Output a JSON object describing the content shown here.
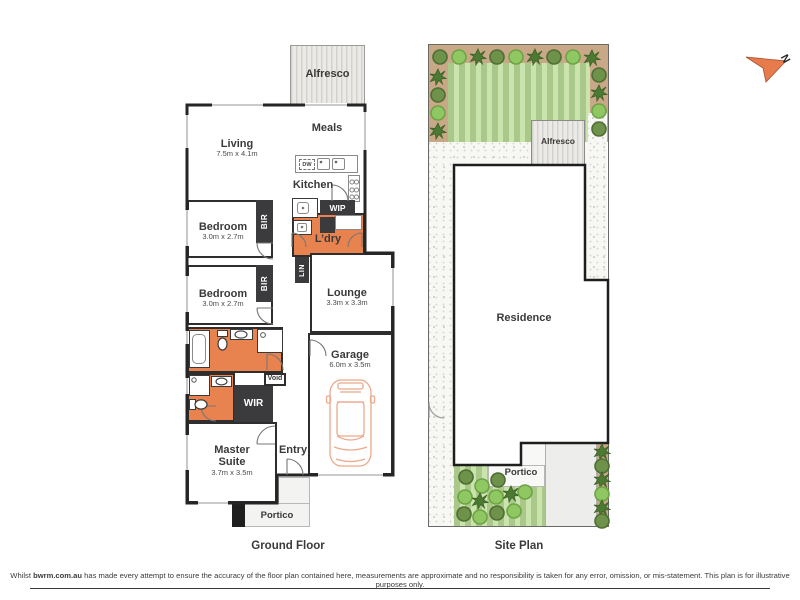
{
  "page": {
    "floor_plan_title": "Ground Floor",
    "site_plan_title": "Site Plan",
    "compass_letter": "N"
  },
  "rooms": {
    "alfresco": "Alfresco",
    "meals": "Meals",
    "living": {
      "name": "Living",
      "dims": "7.5m x 4.1m"
    },
    "kitchen": "Kitchen",
    "dw": "DW",
    "wip": "WIP",
    "ldry": "L’dry",
    "lin": "LIN",
    "bir": "BIR",
    "bedroom": {
      "name": "Bedroom",
      "dims": "3.0m x 2.7m"
    },
    "lounge": {
      "name": "Lounge",
      "dims": "3.3m x 3.3m"
    },
    "garage": {
      "name": "Garage",
      "dims": "6.0m x 3.5m"
    },
    "void": "Void",
    "wir": "WIR",
    "master": {
      "name": "Master Suite",
      "dims": "3.7m x 3.5m"
    },
    "entry": "Entry",
    "portico": "Portico"
  },
  "site": {
    "alfresco": "Alfresco",
    "residence": "Residence",
    "portico": "Portico"
  },
  "disclaimer": {
    "prefix": "Whilst ",
    "brand": "bwrm.com.au",
    "body": " has made every attempt to ensure the accuracy of the floor plan contained here, measurements are approximate and no responsibility is taken for any error, omission, or mis-statement. This plan is for illustrative purposes only."
  },
  "colors": {
    "room_orange": "#E8824E",
    "joinery_charcoal": "#3B3B3D",
    "wall_black": "#252525",
    "lawn_green": "#CBE4AE",
    "garden_bed_tan": "#C9A888",
    "car_outline_orange": "#ECA98B",
    "compass_orange": "#E87B4B"
  }
}
